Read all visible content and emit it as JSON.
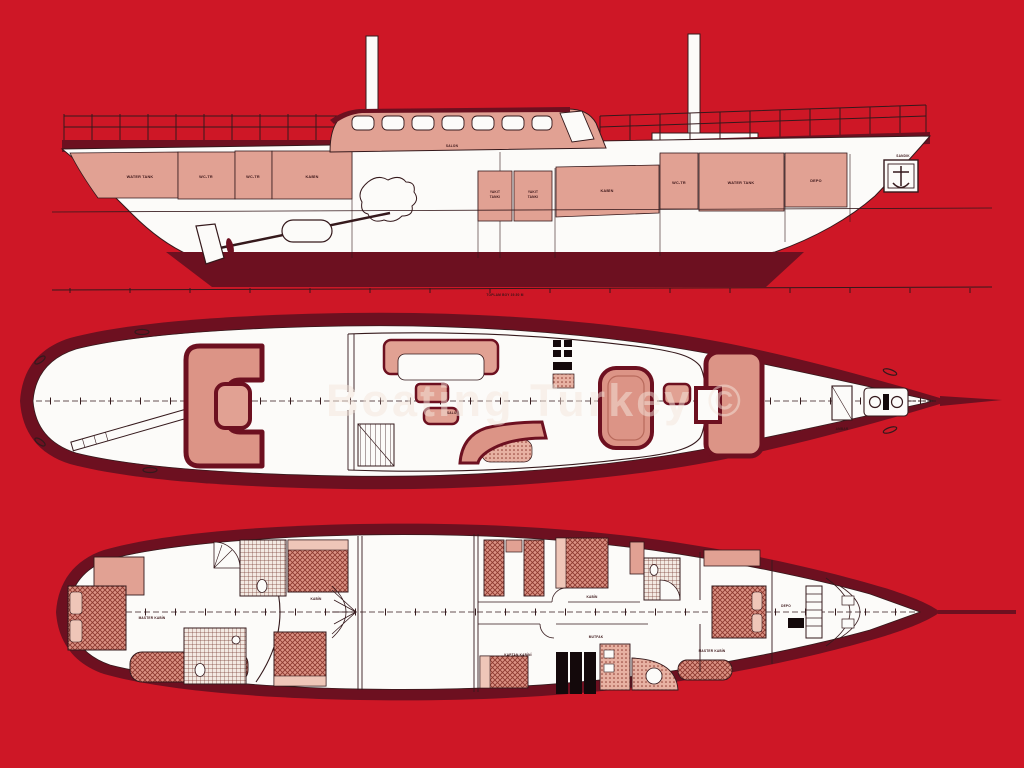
{
  "image_type": "yacht-general-arrangement-plan",
  "watermark": {
    "text": "Boating Turkey ©"
  },
  "palette": {
    "background_red": "#CE1726",
    "outline_maroon": "#6D1020",
    "hull_pink": "#E1A193",
    "bed_pink": "#DB9284",
    "light_pink": "#EFC6B8",
    "paper_white": "#FCFBF9",
    "line_ink": "#35191C",
    "engine_black": "#14090B"
  },
  "profile": {
    "view_name": "side-profile-view",
    "labels": {
      "water_tank_aft": "WATER TANK",
      "wc_1": "WC-TR",
      "wc_2": "WC-TR",
      "cabin_aft": "KABİN",
      "salon": "SALON",
      "fuel_1a": "YAKIT",
      "fuel_1b": "TANKI",
      "fuel_2a": "YAKIT",
      "fuel_2b": "TANKI",
      "cabin_fwd": "KABİN",
      "wc_3": "WC-TR",
      "water_tank_fwd": "WATER TANK",
      "store_fwd": "DEPO",
      "chain_locker": "SANDIK",
      "baseline_note": "TOPLAM BOY 39.50 M"
    }
  },
  "main_deck": {
    "view_name": "main-deck-plan",
    "labels": {
      "salon": "SALON",
      "hatch": "AMBAR"
    }
  },
  "lower_deck": {
    "view_name": "lower-deck-plan",
    "labels": {
      "master_aft": "MASTER KABİN",
      "cabin_aft": "KABİN",
      "cabin_mid": "KABİN",
      "captain": "KAPTAN KABİNİ",
      "galley": "MUTFAK",
      "master_fwd": "MASTER KABİN",
      "store": "DEPO"
    }
  }
}
